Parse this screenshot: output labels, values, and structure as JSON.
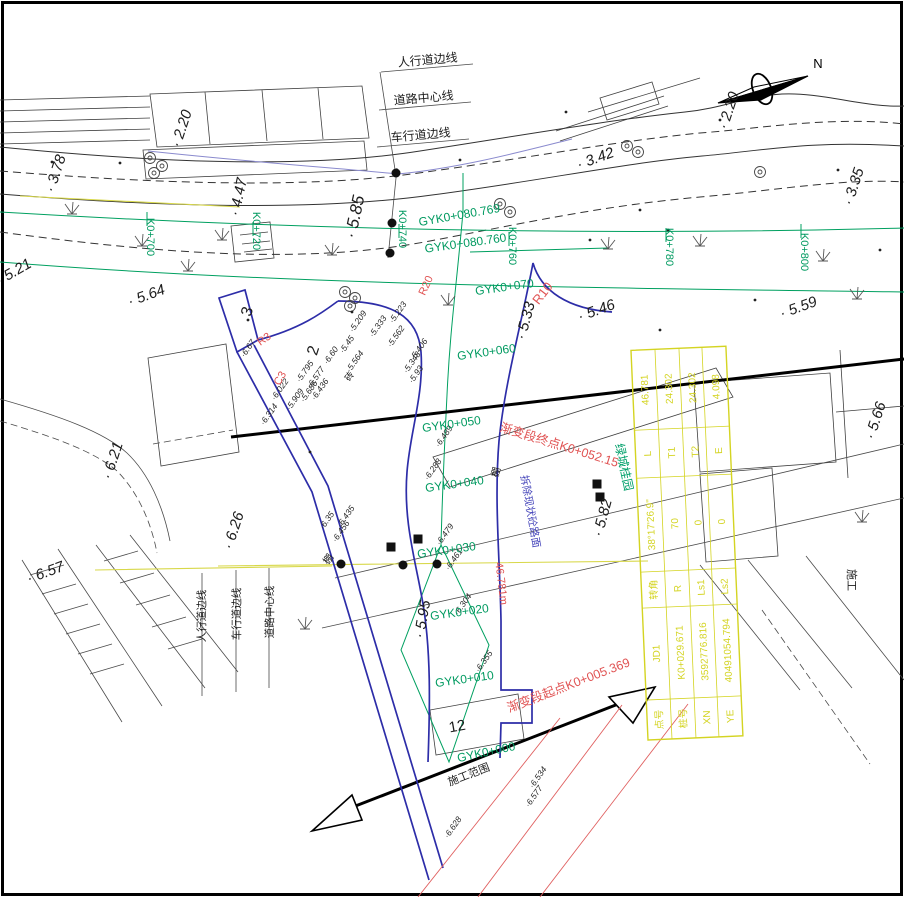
{
  "north": {
    "label": "N"
  },
  "top_edge_labels": [
    [
      "人行道边线",
      428,
      64,
      -5
    ],
    [
      "道路中心线",
      424,
      102,
      -5
    ],
    [
      "车行道边线",
      421,
      139,
      -5
    ]
  ],
  "bottom_edge_labels": [
    [
      "人行道边线",
      205,
      616
    ],
    [
      "车行道边线",
      240,
      614
    ],
    [
      "道路中心线",
      273,
      612
    ]
  ],
  "main_stations": [
    [
      "K0+700",
      147,
      237
    ],
    [
      "K0+720",
      253,
      231
    ],
    [
      "K0+740",
      399,
      229
    ],
    [
      "K0+760",
      509,
      246
    ],
    [
      "K0+780",
      666,
      247
    ],
    [
      "K0+800",
      801,
      252
    ]
  ],
  "side_stations": [
    [
      "GYK0+080.769",
      460,
      219,
      -10
    ],
    [
      "GYK0+080.760",
      466,
      247,
      -8
    ],
    [
      "GYK0+070",
      505,
      291
    ],
    [
      "GYK0+060",
      487,
      356
    ],
    [
      "GYK0+050",
      452,
      428
    ],
    [
      "GYK0+040",
      455,
      488
    ],
    [
      "GYK0+030",
      447,
      554
    ],
    [
      "GYK0+020",
      460,
      616
    ],
    [
      "GYK0+010",
      465,
      683
    ],
    [
      "GYK0+000",
      487,
      756,
      -12
    ]
  ],
  "elevations_large": [
    [
      "2.20",
      186,
      130,
      -72
    ],
    [
      "3.78",
      60,
      175,
      -72
    ],
    [
      "4.47",
      243,
      198,
      -78
    ],
    [
      "5.85",
      360,
      218,
      -78,
      17
    ],
    [
      "5.21",
      16,
      276,
      -30
    ],
    [
      "5.64",
      148,
      300,
      -20
    ],
    [
      "5.33",
      530,
      322,
      -75
    ],
    [
      "5.46",
      598,
      315,
      -20
    ],
    [
      "5.59",
      800,
      312,
      -20
    ],
    [
      "3.42",
      597,
      163,
      -20
    ],
    [
      "3.35",
      858,
      188,
      -72
    ],
    [
      "2.20",
      733,
      112,
      -72
    ],
    [
      "5.66",
      880,
      422,
      -72
    ],
    [
      "6.21",
      117,
      462,
      -72
    ],
    [
      "6.26",
      238,
      532,
      -72
    ],
    [
      "6.57",
      47,
      577,
      -20
    ],
    [
      "5.82",
      607,
      519,
      -75
    ],
    [
      "5.95",
      427,
      620,
      -80
    ]
  ],
  "elevations_small": [
    [
      "6.67",
      250,
      350
    ],
    [
      "6.022",
      282,
      391
    ],
    [
      "5.909",
      297,
      401
    ],
    [
      "6.314",
      271,
      416
    ],
    [
      "5.795",
      307,
      373
    ],
    [
      "6.577",
      318,
      379
    ],
    [
      "6.436",
      322,
      391
    ],
    [
      "5.686",
      311,
      393
    ],
    [
      "5.45",
      349,
      346
    ],
    [
      "5.564",
      357,
      363
    ],
    [
      "5.209",
      360,
      323
    ],
    [
      "5.333",
      380,
      328
    ],
    [
      "5.562",
      398,
      338
    ],
    [
      "5.223",
      400,
      314
    ],
    [
      "5.406",
      421,
      351
    ],
    [
      "5.93",
      418,
      376
    ],
    [
      "5.348",
      414,
      364
    ],
    [
      "6.489",
      446,
      438
    ],
    [
      "6.288",
      435,
      471
    ],
    [
      "6.479",
      447,
      536
    ],
    [
      "6.461",
      456,
      561
    ],
    [
      "6.435",
      348,
      518
    ],
    [
      "6.456",
      343,
      533
    ],
    [
      "6.35",
      329,
      522
    ],
    [
      "6.304",
      465,
      606
    ],
    [
      "6.355",
      486,
      663
    ],
    [
      "6.534",
      540,
      779
    ],
    [
      "6.577",
      536,
      798
    ],
    [
      "6.628",
      455,
      829
    ],
    [
      "6.60",
      333,
      357
    ]
  ],
  "red_notes": [
    [
      "R10",
      546,
      296,
      -52,
      13
    ],
    [
      "R3",
      266,
      342,
      -35,
      11
    ],
    [
      "C3",
      283,
      380,
      -60,
      11
    ],
    [
      "R20",
      429,
      287,
      -65,
      11
    ],
    [
      "渐变段终点K0+052.15",
      558,
      449,
      17,
      12.5
    ],
    [
      "渐变段起点K0+005.369",
      570,
      689,
      -21,
      12.5
    ],
    [
      "46.781m",
      498,
      584,
      83,
      11
    ]
  ],
  "black_notes": [
    [
      "施工范围",
      470,
      778,
      -21,
      11
    ],
    [
      "施工",
      848,
      580,
      90,
      11
    ],
    [
      "12",
      458,
      731,
      -10,
      15
    ],
    [
      "3",
      252,
      313,
      -72,
      16
    ],
    [
      "2",
      318,
      352,
      -72,
      16
    ],
    [
      "砖",
      352,
      378,
      -55,
      9
    ],
    [
      "棚",
      331,
      561,
      -55,
      10
    ],
    [
      "棚",
      499,
      473,
      -75,
      10
    ]
  ],
  "green_notes": [
    [
      "绿城桂园",
      620,
      468,
      78,
      12
    ]
  ],
  "blue_notes": [
    [
      "拆除现状砼路面",
      527,
      512,
      80,
      10.5
    ]
  ],
  "curve_table": {
    "rows": [
      [
        "点号",
        "JD1",
        "转角",
        "38°17'26.9\"",
        "L",
        "46.781"
      ],
      [
        "桩号",
        "K0+029.671",
        "R",
        "70",
        "T1",
        "24.302"
      ],
      [
        "XN",
        "3592776.816",
        "Ls1",
        "0",
        "T2",
        "24.302"
      ],
      [
        "YE",
        "40491054.794",
        "Ls2",
        "0",
        "E",
        "4.098"
      ]
    ]
  },
  "symbols": {
    "dots": [
      [
        396,
        173
      ],
      [
        392,
        223
      ],
      [
        390,
        253
      ],
      [
        341,
        564
      ],
      [
        403,
        565
      ],
      [
        437,
        564
      ]
    ],
    "squares": [
      [
        597,
        484
      ],
      [
        600,
        497
      ],
      [
        391,
        547
      ],
      [
        418,
        539
      ]
    ],
    "trees": [
      [
        150,
        158
      ],
      [
        162,
        166
      ],
      [
        154,
        173
      ],
      [
        500,
        204
      ],
      [
        510,
        212
      ],
      [
        345,
        292
      ],
      [
        355,
        298
      ],
      [
        350,
        306
      ],
      [
        627,
        146
      ],
      [
        638,
        152
      ],
      [
        760,
        172
      ]
    ],
    "grass": [
      [
        72,
        212
      ],
      [
        142,
        244
      ],
      [
        222,
        238
      ],
      [
        188,
        269
      ],
      [
        332,
        253
      ],
      [
        700,
        244
      ],
      [
        823,
        259
      ],
      [
        857,
        297
      ],
      [
        305,
        627
      ],
      [
        862,
        520
      ],
      [
        448,
        303
      ],
      [
        608,
        247
      ]
    ],
    "point_dots": [
      [
        52,
        162
      ],
      [
        120,
        163
      ],
      [
        248,
        320
      ],
      [
        352,
        312
      ],
      [
        566,
        112
      ],
      [
        668,
        230
      ],
      [
        720,
        120
      ],
      [
        838,
        170
      ],
      [
        880,
        250
      ],
      [
        310,
        452
      ],
      [
        660,
        330
      ],
      [
        755,
        300
      ],
      [
        590,
        240
      ],
      [
        460,
        160
      ],
      [
        640,
        210
      ]
    ]
  },
  "colors": {
    "green_line": "#00a060",
    "blue_design": "#2d2da8",
    "red_annotation": "#e05353",
    "yellow_table": "#d4d422",
    "yellow_line": "#d8d84a",
    "purple_line": "#8a8ace"
  }
}
